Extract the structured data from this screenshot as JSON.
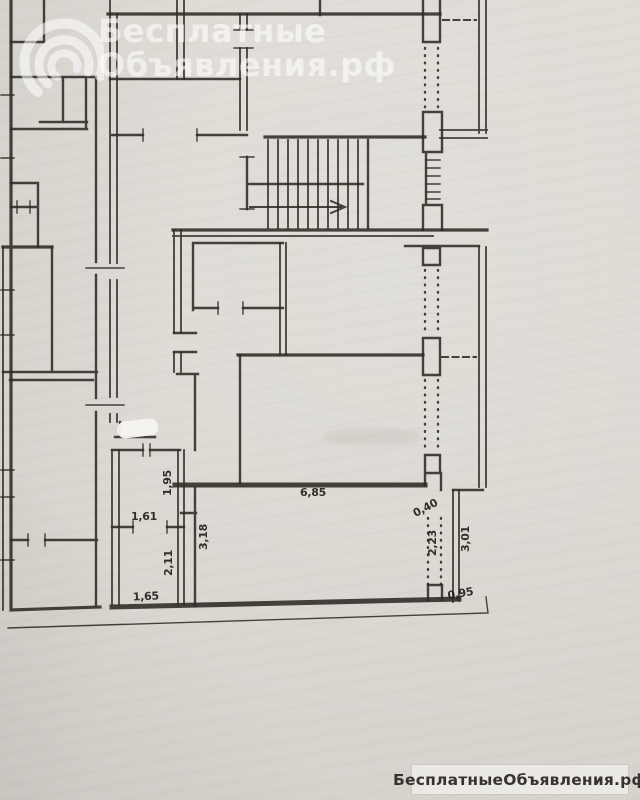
{
  "watermark": {
    "logo": "swirl-logo-icon",
    "line1": "Бесплатные",
    "line2": "Объявления.рф"
  },
  "footer": {
    "badge_text": "БесплатныеОбъявления.рф"
  },
  "plan": {
    "dimensions": {
      "v195": "1,95",
      "v685": "6,85",
      "v161": "1,61",
      "v318": "3,18",
      "v211": "2,11",
      "v165": "1,65",
      "v040": "0,40",
      "v223": "2,23",
      "v301": "3,01",
      "v095": "0,95"
    }
  }
}
